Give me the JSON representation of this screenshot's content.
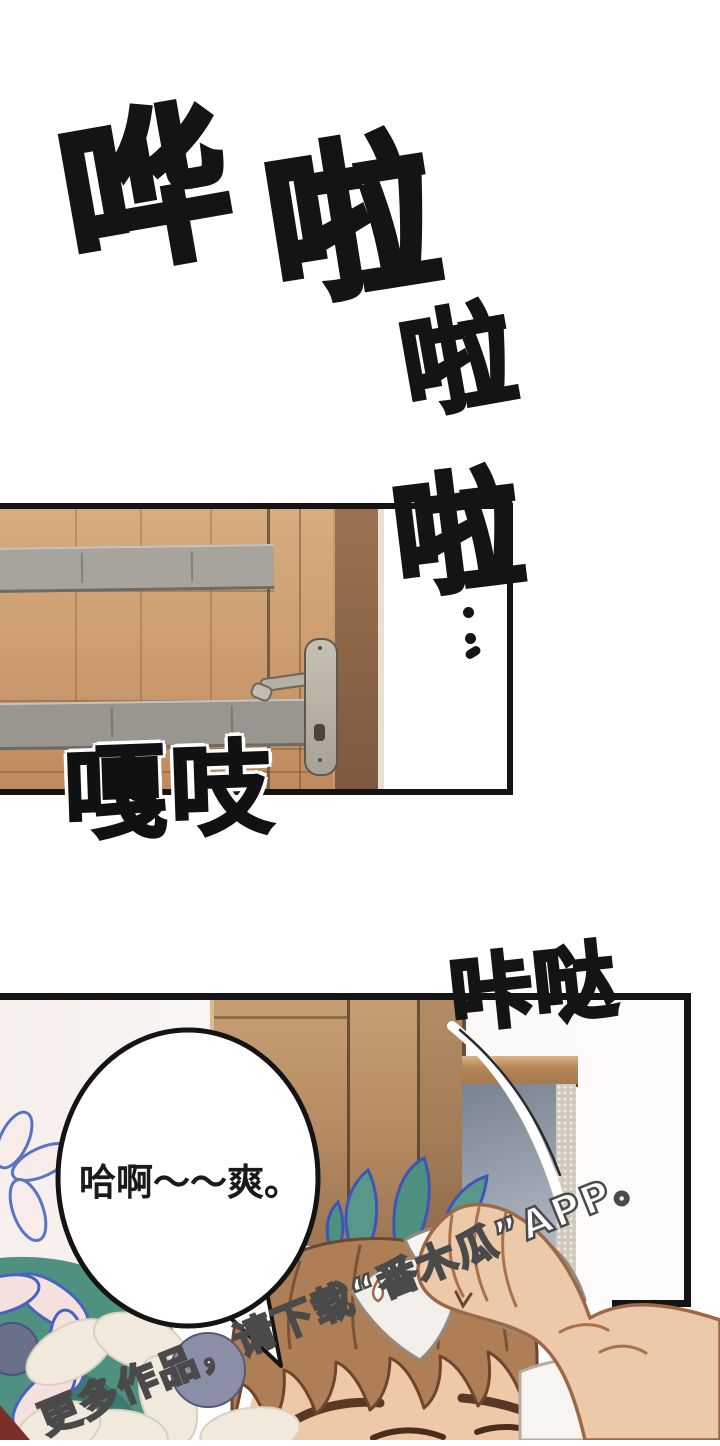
{
  "page": {
    "kind": "webtoon-comic-page",
    "width": 720,
    "height": 1440
  },
  "sfx": {
    "hua": "哗",
    "la1": "啦",
    "la2": "啦",
    "la3": "啦",
    "creak": "嘎吱",
    "click": "咔哒"
  },
  "bubble": {
    "text": "哈啊～～爽。"
  },
  "watermark": {
    "text": "更多作品，请下载“番木瓜”APP。"
  },
  "colors": {
    "ink": "#141414",
    "door_wood": "#cd9f73",
    "door_dark_strip": "#8a6448",
    "kick_plate_gray": "#a7a39d",
    "handle_metal": "#b5b0a4",
    "wardrobe_wood": "#b58a61",
    "mirror_glass_blue": "#9aa2af",
    "hair_brown": "#ae7e57",
    "hair_outline": "#6e452e",
    "skin": "#ecc9a9",
    "skin_outline": "#9c6848",
    "towel_white": "#f7f5f2",
    "leaf_teal": "#4f9181",
    "leaf_outline_blue": "#3c55b8",
    "petal_pink": "#f5e0dd",
    "petal_cream": "#f0e9dc",
    "flower_center_gray": "#6b7089",
    "ball_gray_blue": "#8a8ea6",
    "corner_dark_red": "#7c2f2a",
    "watermark_fill": "#ffffff",
    "watermark_outline": "#4a4a4a"
  }
}
